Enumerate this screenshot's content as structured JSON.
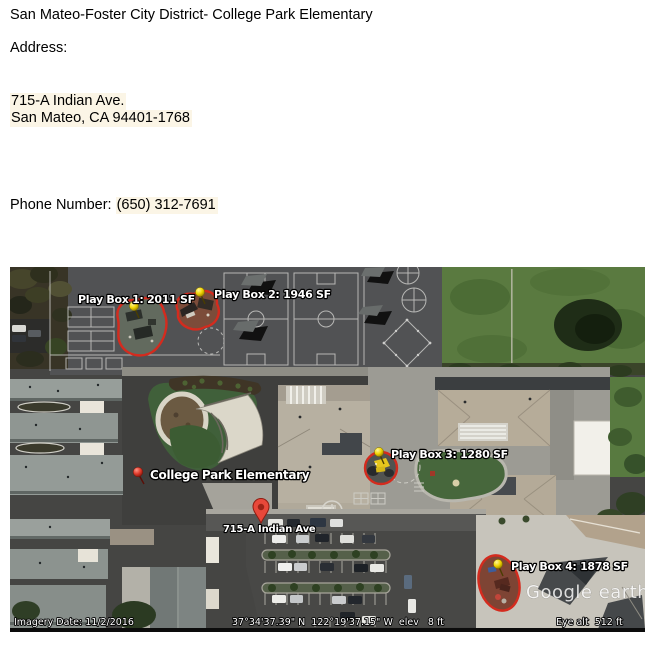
{
  "document": {
    "title": "San Mateo-Foster City District- College Park Elementary",
    "address_label": "Address:",
    "address_line1": "715-A Indian Ave.",
    "address_line2": "San Mateo, CA 94401-1768",
    "phone_label": "Phone Number: ",
    "phone_value": "(650) 312-7691"
  },
  "map": {
    "play_boxes": [
      {
        "label": "Play Box 1: 2011 SF",
        "area_sf": 2011
      },
      {
        "label": "Play Box 2: 1946 SF",
        "area_sf": 1946
      },
      {
        "label": "Play Box 3: 1280 SF",
        "area_sf": 1280
      },
      {
        "label": "Play Box 4: 1878 SF",
        "area_sf": 1878
      }
    ],
    "markers": {
      "school": "College Park Elementary",
      "street": "715-A Indian Ave"
    },
    "watermark": "Google earth",
    "status": {
      "imagery_date": "Imagery Date: 11/2/2016",
      "coordinates": "37°34'37.39\" N  122°19'37.15\" W  elev   8 ft",
      "eye_alt": "Eye alt  512 ft"
    },
    "colors": {
      "outline_red": "#d42b1e",
      "pushpin_yellow": "#f0d400",
      "pushpin_red": "#df3a2b",
      "marker_red": "#e8483a"
    }
  }
}
